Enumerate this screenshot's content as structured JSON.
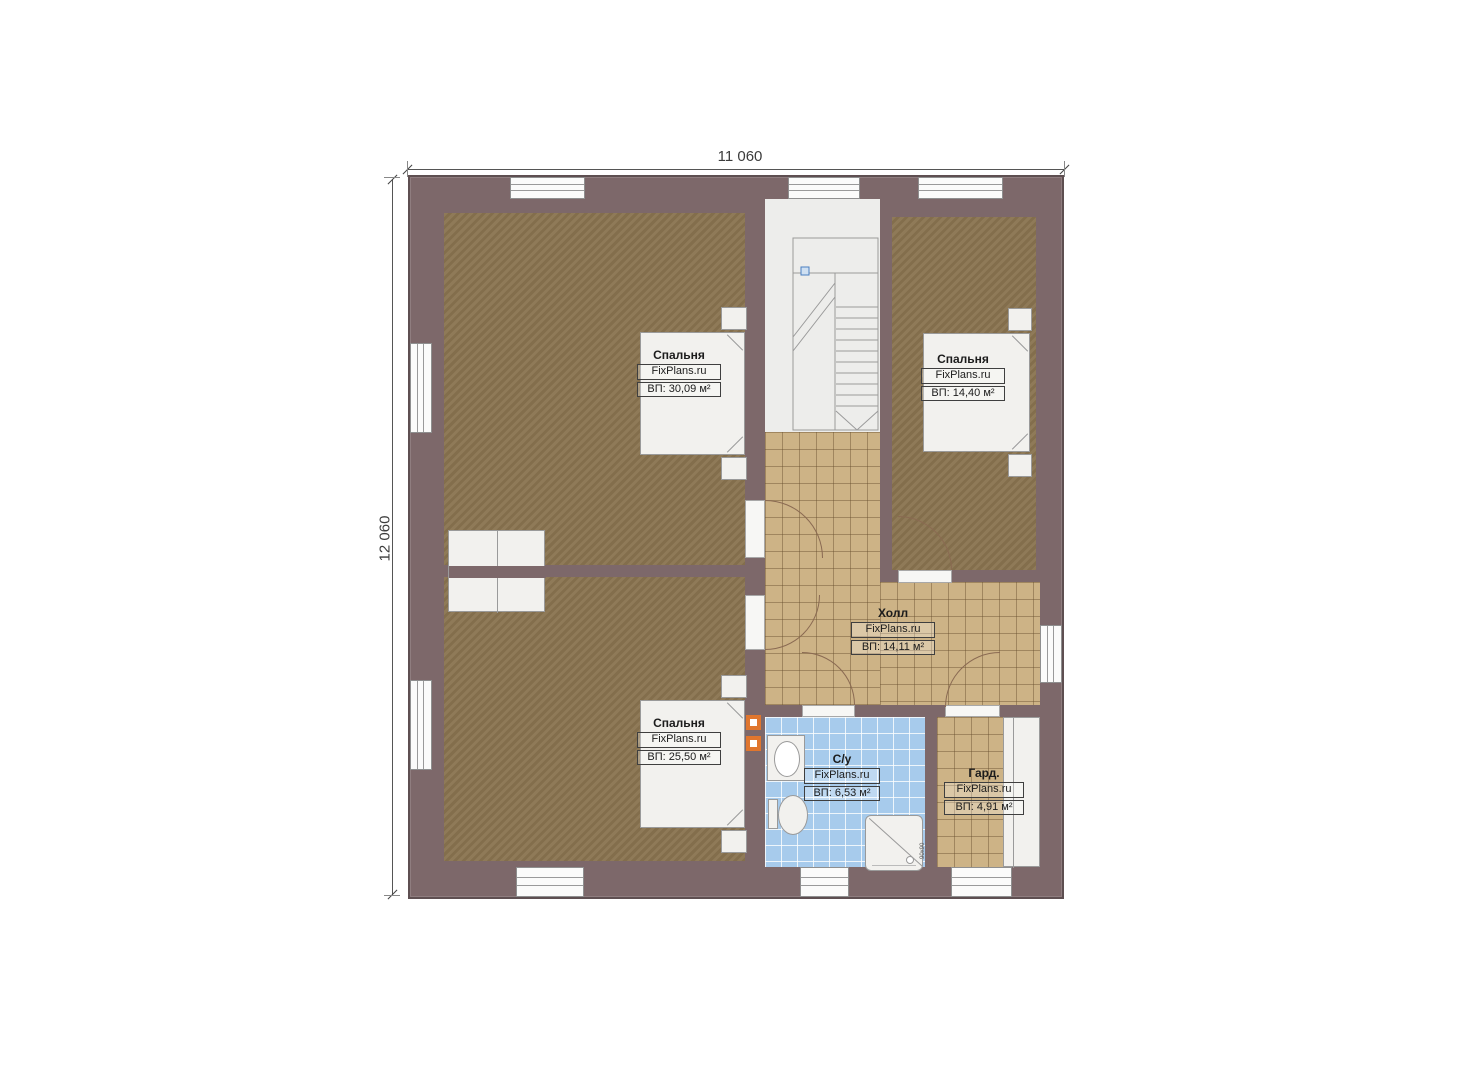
{
  "plan": {
    "dimensions": {
      "width": "11 060",
      "height": "12 060"
    },
    "rooms": [
      {
        "key": "bedroom-top-left",
        "name": "Спальня",
        "watermark": "FixPlans.ru",
        "area": "ВП: 30,09 м²"
      },
      {
        "key": "bedroom-top-right",
        "name": "Спальня",
        "watermark": "FixPlans.ru",
        "area": "ВП: 14,40 м²"
      },
      {
        "key": "hall",
        "name": "Холл",
        "watermark": "FixPlans.ru",
        "area": "ВП: 14,11 м²"
      },
      {
        "key": "bedroom-bottom-left",
        "name": "Спальня",
        "watermark": "FixPlans.ru",
        "area": "ВП: 25,50 м²"
      },
      {
        "key": "bathroom",
        "name": "С/у",
        "watermark": "FixPlans.ru",
        "area": "ВП: 6,53 м²"
      },
      {
        "key": "wardrobe",
        "name": "Гард.",
        "watermark": "FixPlans.ru",
        "area": "ВП: 4,91 м²"
      }
    ],
    "shower": {
      "size_label": "90х90"
    },
    "colors": {
      "wall": "#7d686a",
      "wall_outline": "#5e4f51",
      "carpet": "#8a7450",
      "tile_beige": "#cdb386",
      "tile_blue": "#a7cbec",
      "stair_floor": "#ededeb",
      "fixture_orange": "#e0762e",
      "dimension_text": "#3c3c3c"
    }
  }
}
